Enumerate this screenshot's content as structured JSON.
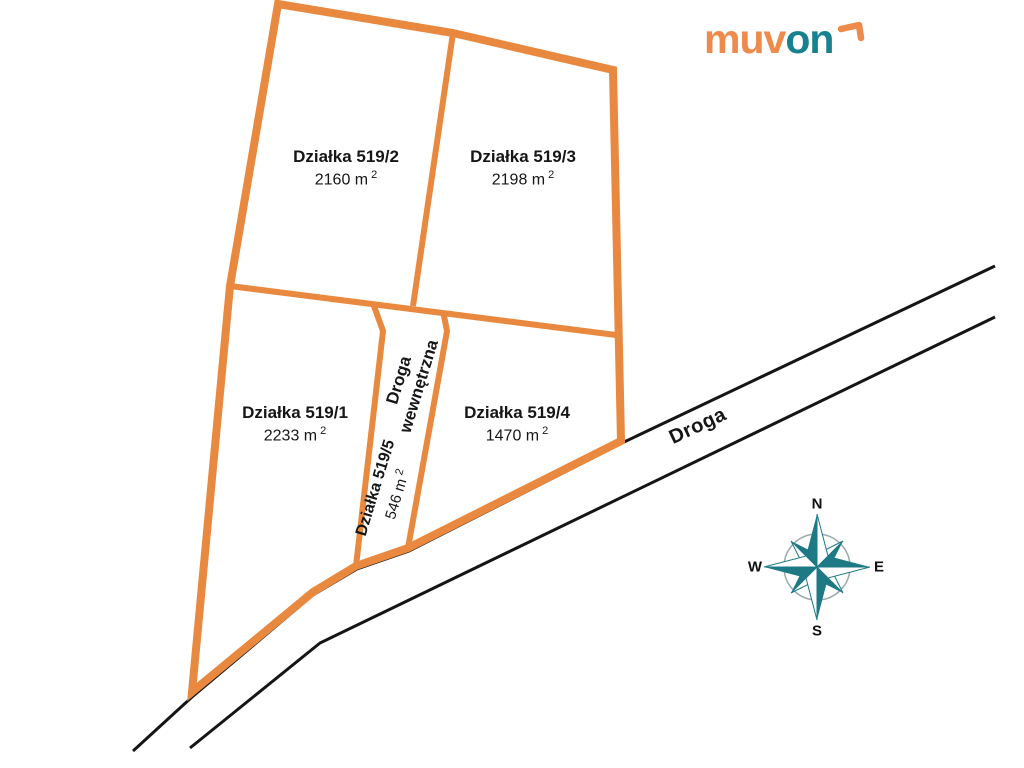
{
  "logo": {
    "text_primary": "muv",
    "text_secondary": "on"
  },
  "parcels": [
    {
      "name": "Działka 519/2",
      "area_value": "2160 m",
      "area_sup": "2"
    },
    {
      "name": "Działka 519/3",
      "area_value": "2198 m",
      "area_sup": "2"
    },
    {
      "name": "Działka 519/1",
      "area_value": "2233 m",
      "area_sup": "2"
    },
    {
      "name": "Działka 519/4",
      "area_value": "1470 m",
      "area_sup": "2"
    },
    {
      "name": "Działka 519/5",
      "area_value": "546 m",
      "area_sup": "2"
    }
  ],
  "roads": {
    "main_road_label": "Droga",
    "internal_road_label_line1": "Droga",
    "internal_road_label_line2": "wewnętrzna"
  },
  "compass": {
    "north": "N",
    "east": "E",
    "south": "S",
    "west": "W"
  },
  "colors": {
    "boundary_orange": "#E8893F",
    "logo_orange": "#ED8A4C",
    "logo_teal": "#17818F",
    "compass_teal": "#1D7A85",
    "road_black": "#151515"
  }
}
